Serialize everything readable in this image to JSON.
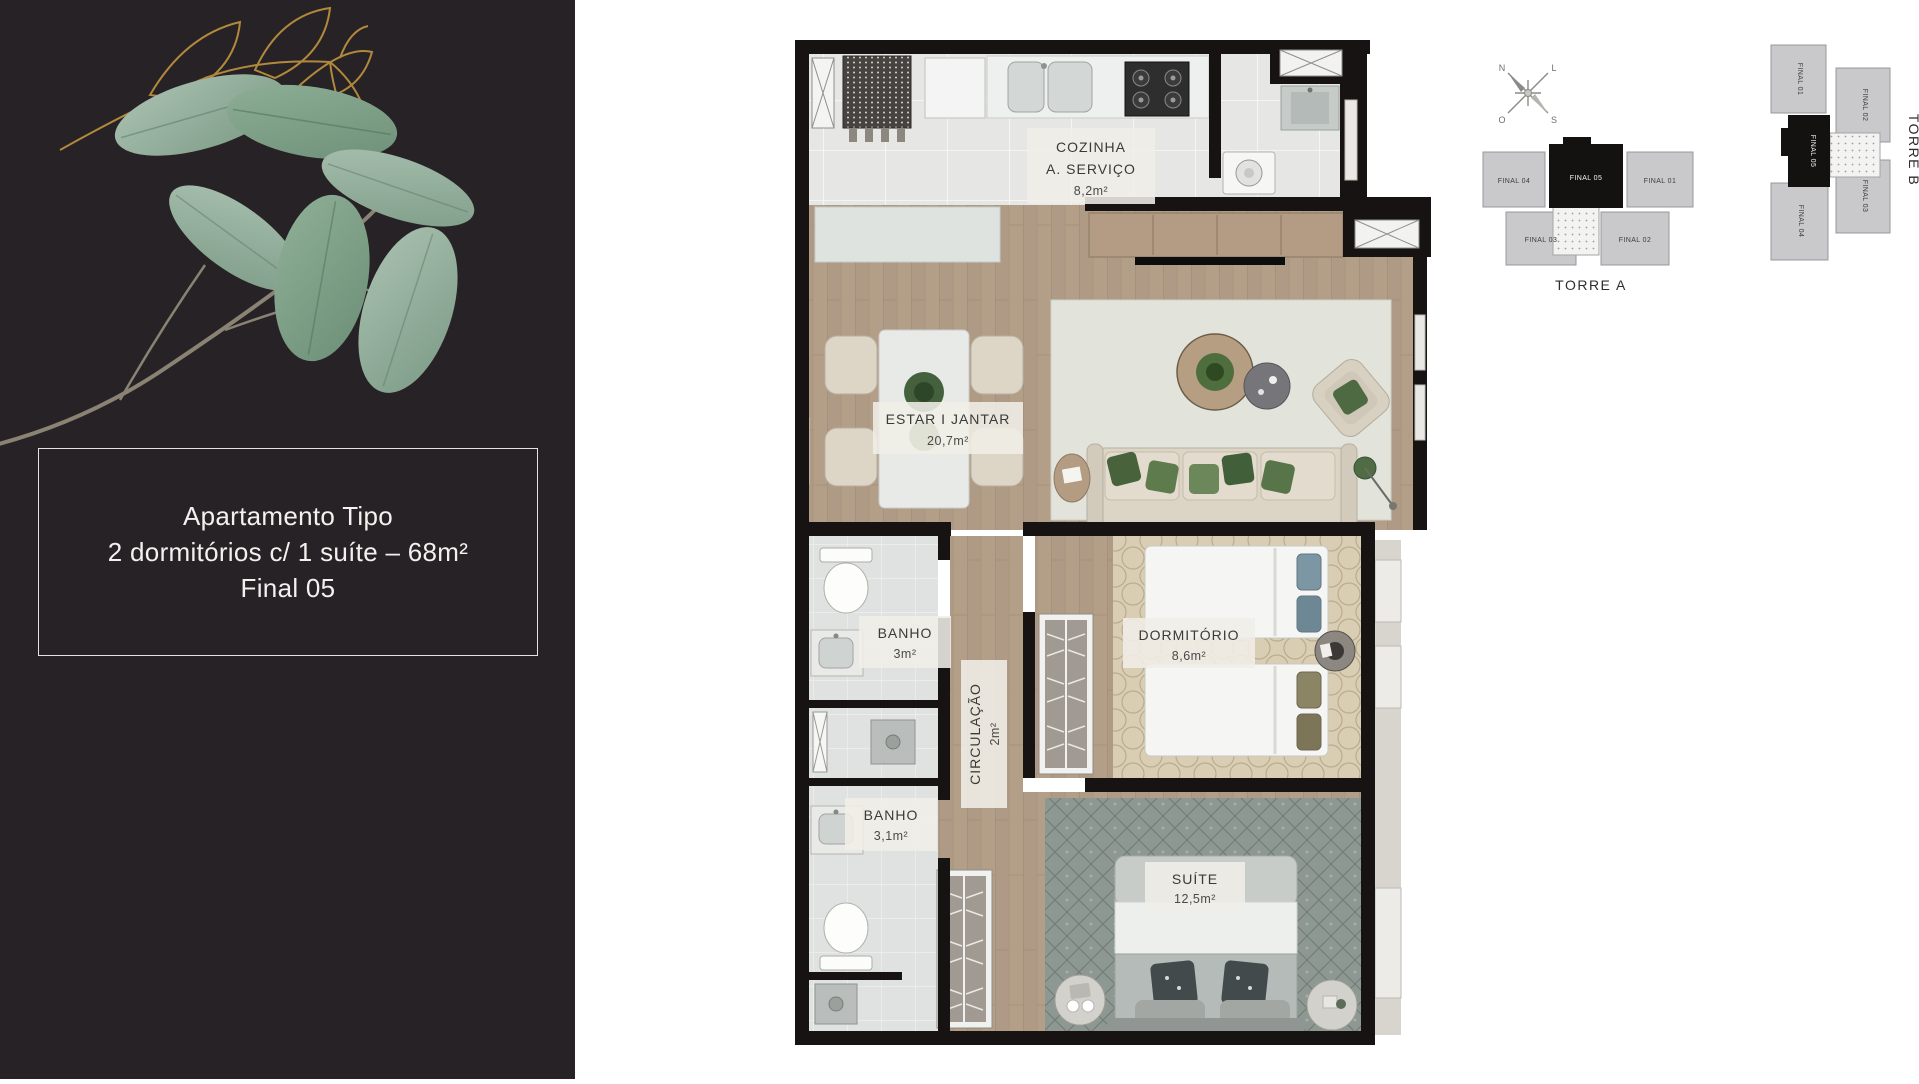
{
  "sidebar": {
    "card": {
      "line1": "Apartamento Tipo",
      "line2": "2 dormitórios c/ 1 suíte – 68m²",
      "line3": "Final 05"
    }
  },
  "plan": {
    "rooms": {
      "cozinha": {
        "name": "COZINHA",
        "name2": "A. SERVIÇO",
        "area": "8,2m²"
      },
      "estar": {
        "name": "ESTAR I JANTAR",
        "area": "20,7m²"
      },
      "banho1": {
        "name": "BANHO",
        "area": "3m²"
      },
      "circulacao": {
        "name": "CIRCULAÇÃO",
        "area": "2m²"
      },
      "dormitorio": {
        "name": "DORMITÓRIO",
        "area": "8,6m²"
      },
      "banho2": {
        "name": "BANHO",
        "area": "3,1m²"
      },
      "suite": {
        "name": "SUÍTE",
        "area": "12,5m²"
      }
    },
    "colors": {
      "wall": "#171313",
      "wood": "#b39e88",
      "tile": "#e6e7e5",
      "highlight_unit": "#141111"
    }
  },
  "keyplans": {
    "torre_a": {
      "title": "TORRE A",
      "units": {
        "f01": "FINAL 01",
        "f02": "FINAL 02",
        "f03": "FINAL 03",
        "f04": "FINAL 04",
        "f05": "FINAL 05"
      }
    },
    "torre_b": {
      "title": "TORRE B",
      "units": {
        "f01": "FINAL 01",
        "f02": "FINAL 02",
        "f03": "FINAL 03",
        "f04": "FINAL 04",
        "f05": "FINAL 05"
      }
    },
    "highlighted_unit": "FINAL 05"
  },
  "compass": {
    "n": "N",
    "l": "L",
    "s": "S",
    "o": "O"
  }
}
